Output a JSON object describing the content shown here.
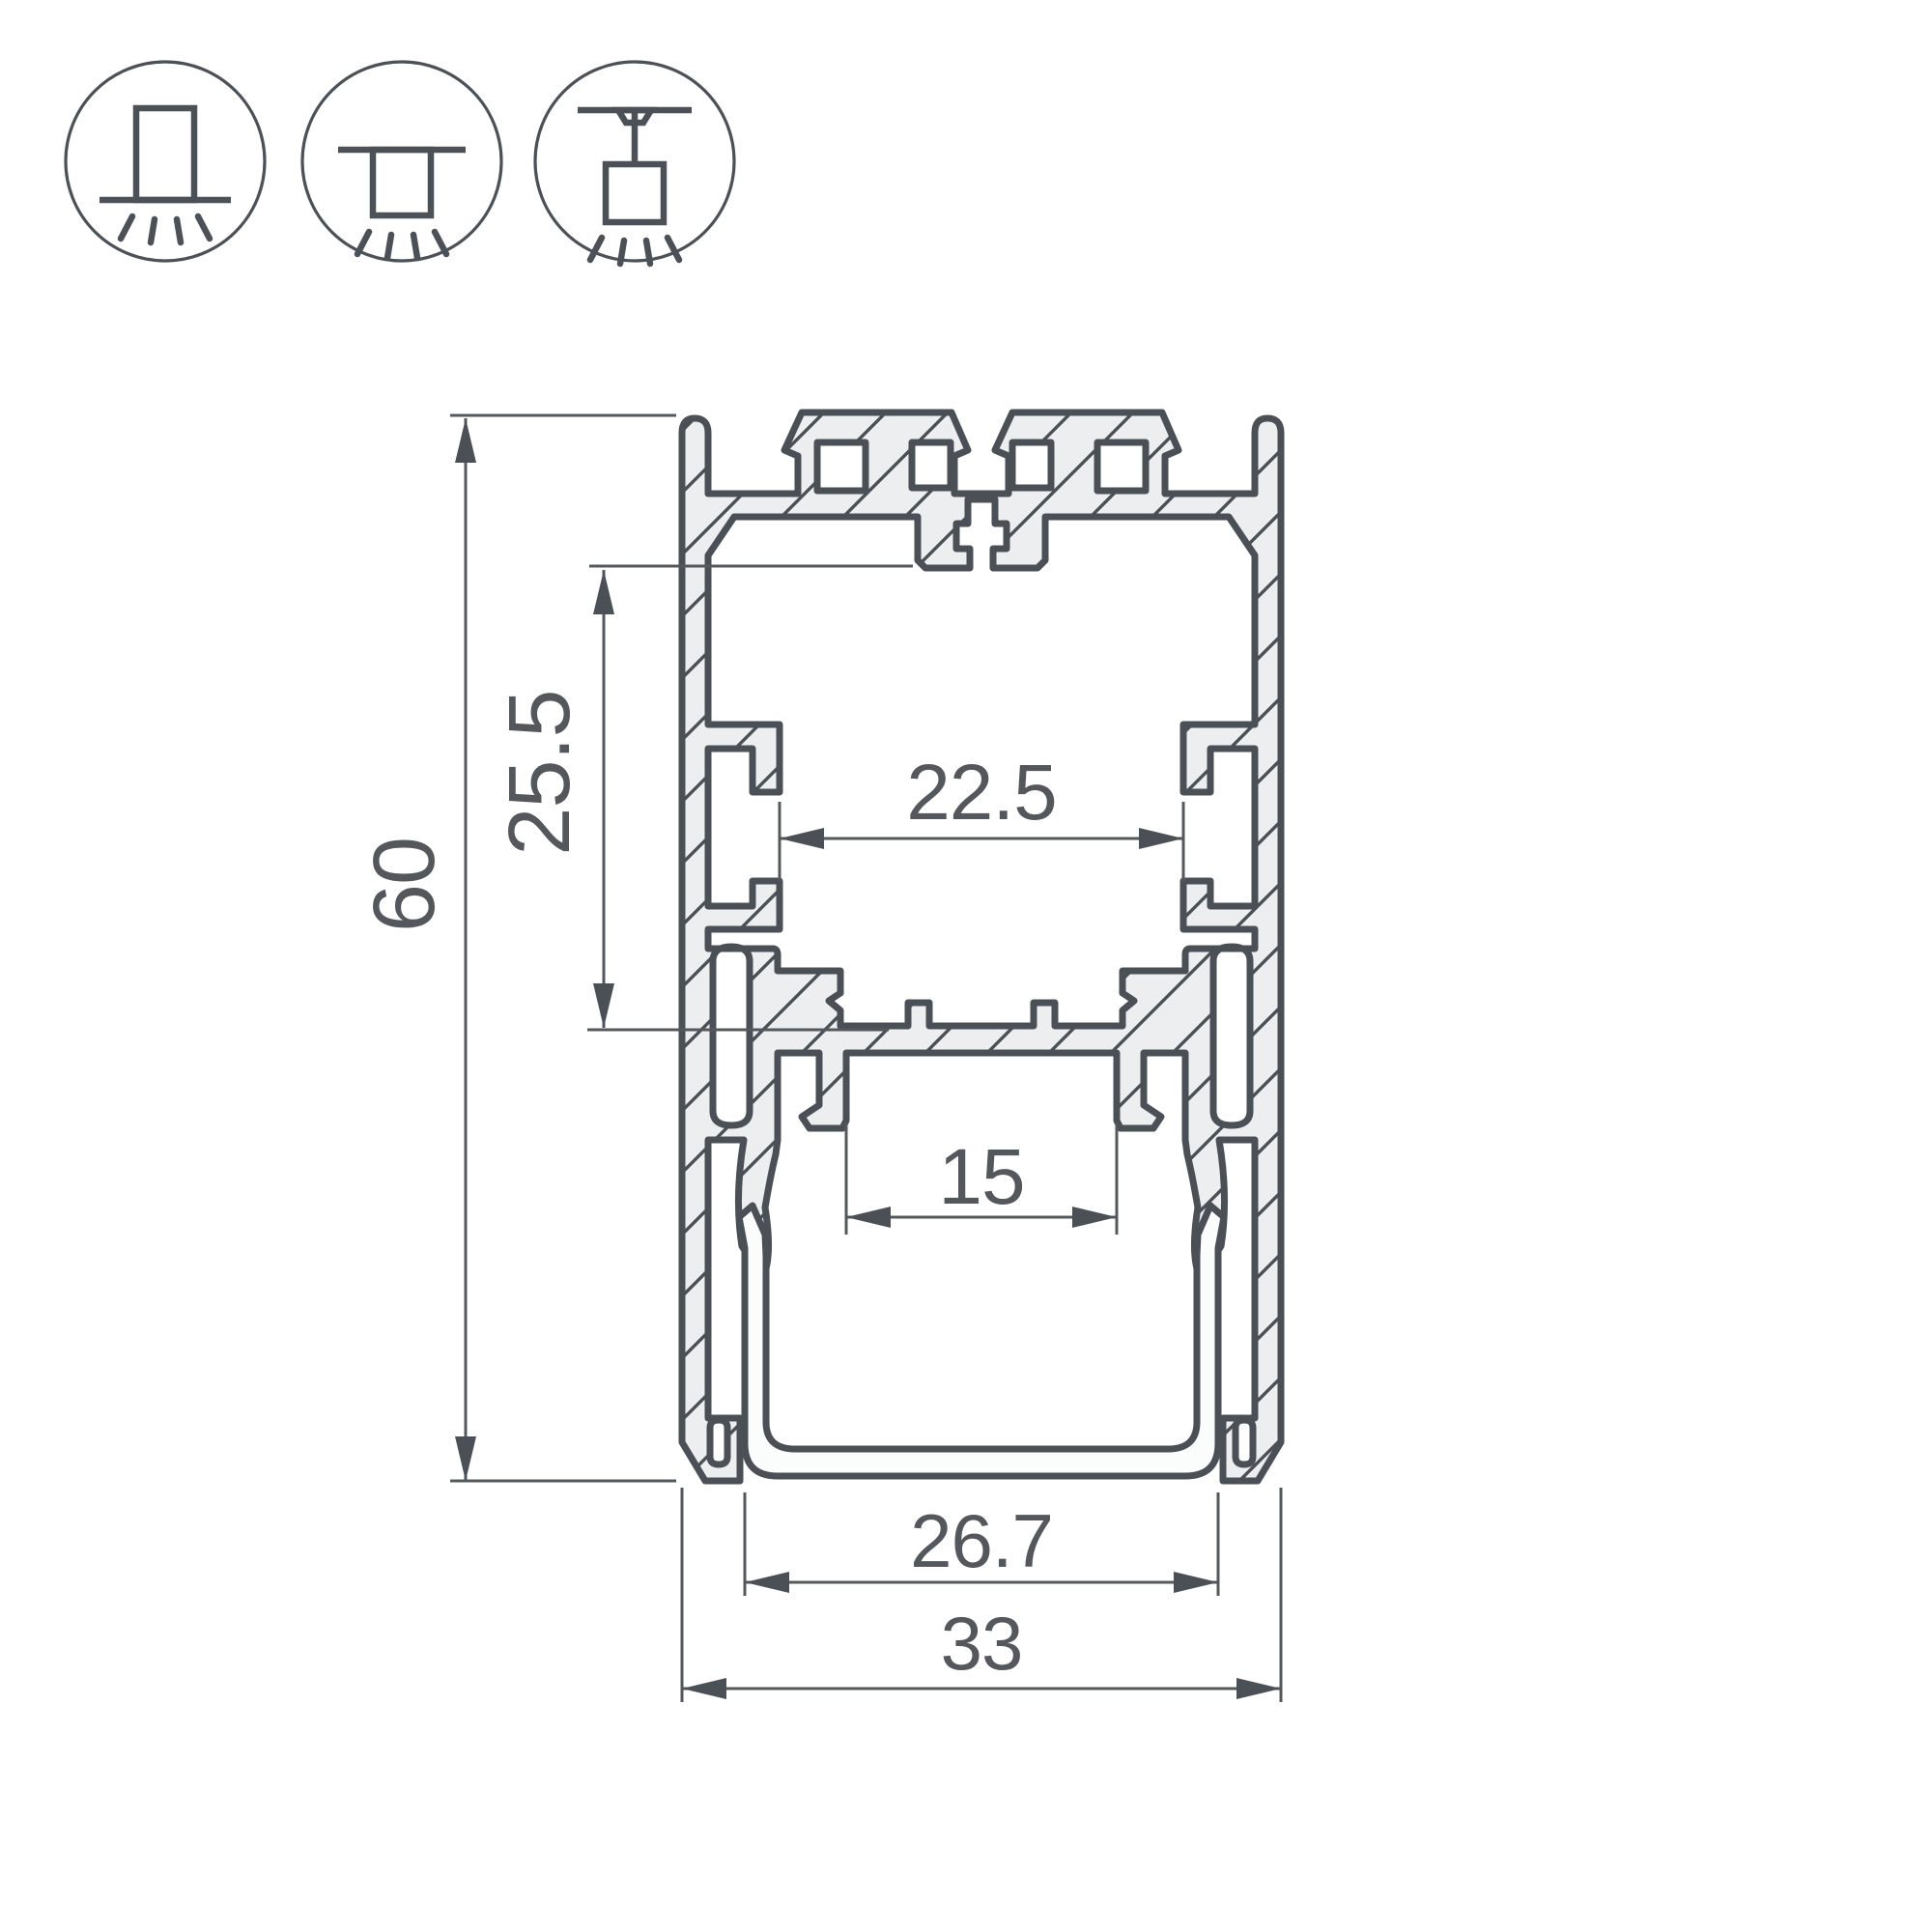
{
  "drawing": {
    "title": "led-profile-cross-section",
    "background_color": "#ffffff",
    "outline_color": "#4b5056",
    "dimension_color": "#54585c",
    "metal_fill_color": "#edeef0"
  },
  "mount_icons": [
    {
      "name": "surface-mount-icon",
      "description": "profile mounted on surface, light emitted downward"
    },
    {
      "name": "recessed-mount-icon",
      "description": "profile recessed into ceiling, light emitted downward"
    },
    {
      "name": "suspended-mount-icon",
      "description": "profile suspended from ceiling, light emitted downward"
    }
  ],
  "dimensions": {
    "overall_height": {
      "label": "60"
    },
    "cavity_height": {
      "label": "25.5"
    },
    "inner_width": {
      "label": "22.5"
    },
    "led_shelf_width": {
      "label": "15"
    },
    "diffuser_width": {
      "label": "26.7"
    },
    "overall_width": {
      "label": "33"
    }
  }
}
